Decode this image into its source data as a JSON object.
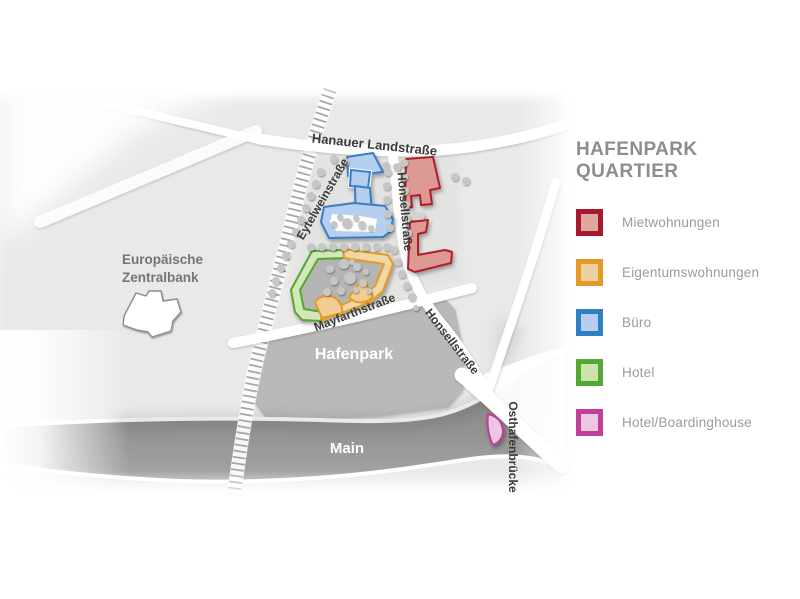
{
  "legend": {
    "title": "HAFENPARK QUARTIER",
    "title_color": "#8b8e91",
    "text_color": "#9b9b9b",
    "items": [
      {
        "label": "Mietwohnungen",
        "fill": "#dfa79e",
        "border": "#a6192e"
      },
      {
        "label": "Eigentumswohnungen",
        "fill": "#eed0a3",
        "border": "#e49b25"
      },
      {
        "label": "Büro",
        "fill": "#b6cff0",
        "border": "#2f80c3"
      },
      {
        "label": "Hotel",
        "fill": "#cce3ae",
        "border": "#54a733"
      },
      {
        "label": "Hotel/Boardinghouse",
        "fill": "#edc7e2",
        "border": "#bf3f9a"
      }
    ]
  },
  "map": {
    "streets": {
      "hanauer": "Hanauer Landstraße",
      "eytelwein": "Eytelweinstraße",
      "honsell_upper": "Honsellstraße",
      "honsell_lower": "Honsellstraße",
      "mayfarth": "Mayfarthstraße",
      "osthafen": "Osthafenbrücke"
    },
    "areas": {
      "ecb_line1": "Europäische",
      "ecb_line2": "Zentralbank",
      "park": "Hafenpark",
      "river": "Main"
    },
    "colors": {
      "base": "#e9e9e8",
      "block": "#e3e3e2",
      "park": "#b9b9b8",
      "courtyard": "#b4b4b3",
      "railway_tick": "#a7a7a6",
      "road": "#ffffff",
      "tree": "#c6c6c5",
      "street_text": "#3b3b3a",
      "area_text": "#747white",
      "ecb_text": "#737578",
      "connector": "#d2d2d1",
      "miet_fill": "#dc9a92",
      "miet_stroke": "#b01f2f",
      "eigentum_fill": "#f1d6a6",
      "eigentum_stroke": "#e49b25",
      "fan_fill": "#f2cc95",
      "buero_fill": "#b5cff0",
      "buero_stroke": "#3a7ec2",
      "hotel_fill": "#d3e7ba",
      "hotel_stroke": "#54a733",
      "board_fill": "#edc7e2",
      "board_stroke": "#bf3f9a",
      "ecb_fill": "#ffffff",
      "ecb_stroke": "#8c8c8b"
    },
    "trees": [
      [
        334,
        159,
        4
      ],
      [
        345,
        162,
        4
      ],
      [
        386,
        166,
        4
      ],
      [
        397,
        167,
        4
      ],
      [
        455,
        177,
        4
      ],
      [
        466,
        181,
        4
      ],
      [
        321,
        172,
        4
      ],
      [
        316,
        184,
        4
      ],
      [
        311,
        196,
        4
      ],
      [
        306,
        208,
        4
      ],
      [
        301,
        220,
        4
      ],
      [
        296,
        232,
        4
      ],
      [
        291,
        244,
        4
      ],
      [
        286,
        256,
        4
      ],
      [
        281,
        268,
        4
      ],
      [
        276,
        281,
        4
      ],
      [
        272,
        293,
        4
      ],
      [
        311,
        247,
        4
      ],
      [
        322,
        247,
        4
      ],
      [
        333,
        247,
        4
      ],
      [
        344,
        247,
        4
      ],
      [
        355,
        247,
        4
      ],
      [
        366,
        247,
        4
      ],
      [
        377,
        247,
        4
      ],
      [
        387,
        247,
        4
      ],
      [
        388,
        172,
        4
      ],
      [
        387,
        186,
        4
      ],
      [
        387,
        200,
        4
      ],
      [
        388,
        214,
        4
      ],
      [
        390,
        228,
        4
      ],
      [
        404,
        163,
        4
      ],
      [
        404,
        177,
        4
      ],
      [
        405,
        191,
        4
      ],
      [
        406,
        205,
        4
      ],
      [
        407,
        219,
        4
      ],
      [
        408,
        233,
        4
      ],
      [
        394,
        250,
        4
      ],
      [
        398,
        262,
        4
      ],
      [
        402,
        274,
        4
      ],
      [
        407,
        286,
        4
      ],
      [
        412,
        297,
        4
      ],
      [
        416,
        308,
        3
      ],
      [
        347,
        223,
        5
      ],
      [
        362,
        225,
        4
      ],
      [
        334,
        224,
        3
      ],
      [
        371,
        228,
        3
      ],
      [
        340,
        217,
        3
      ],
      [
        356,
        218,
        3
      ],
      [
        330,
        269,
        4
      ],
      [
        344,
        264,
        5
      ],
      [
        357,
        267,
        4
      ],
      [
        334,
        281,
        4
      ],
      [
        350,
        278,
        6
      ],
      [
        327,
        292,
        4
      ],
      [
        363,
        283,
        4
      ],
      [
        369,
        291,
        3
      ],
      [
        341,
        291,
        4
      ],
      [
        356,
        290,
        3
      ],
      [
        352,
        262,
        3
      ],
      [
        366,
        272,
        3
      ]
    ]
  }
}
